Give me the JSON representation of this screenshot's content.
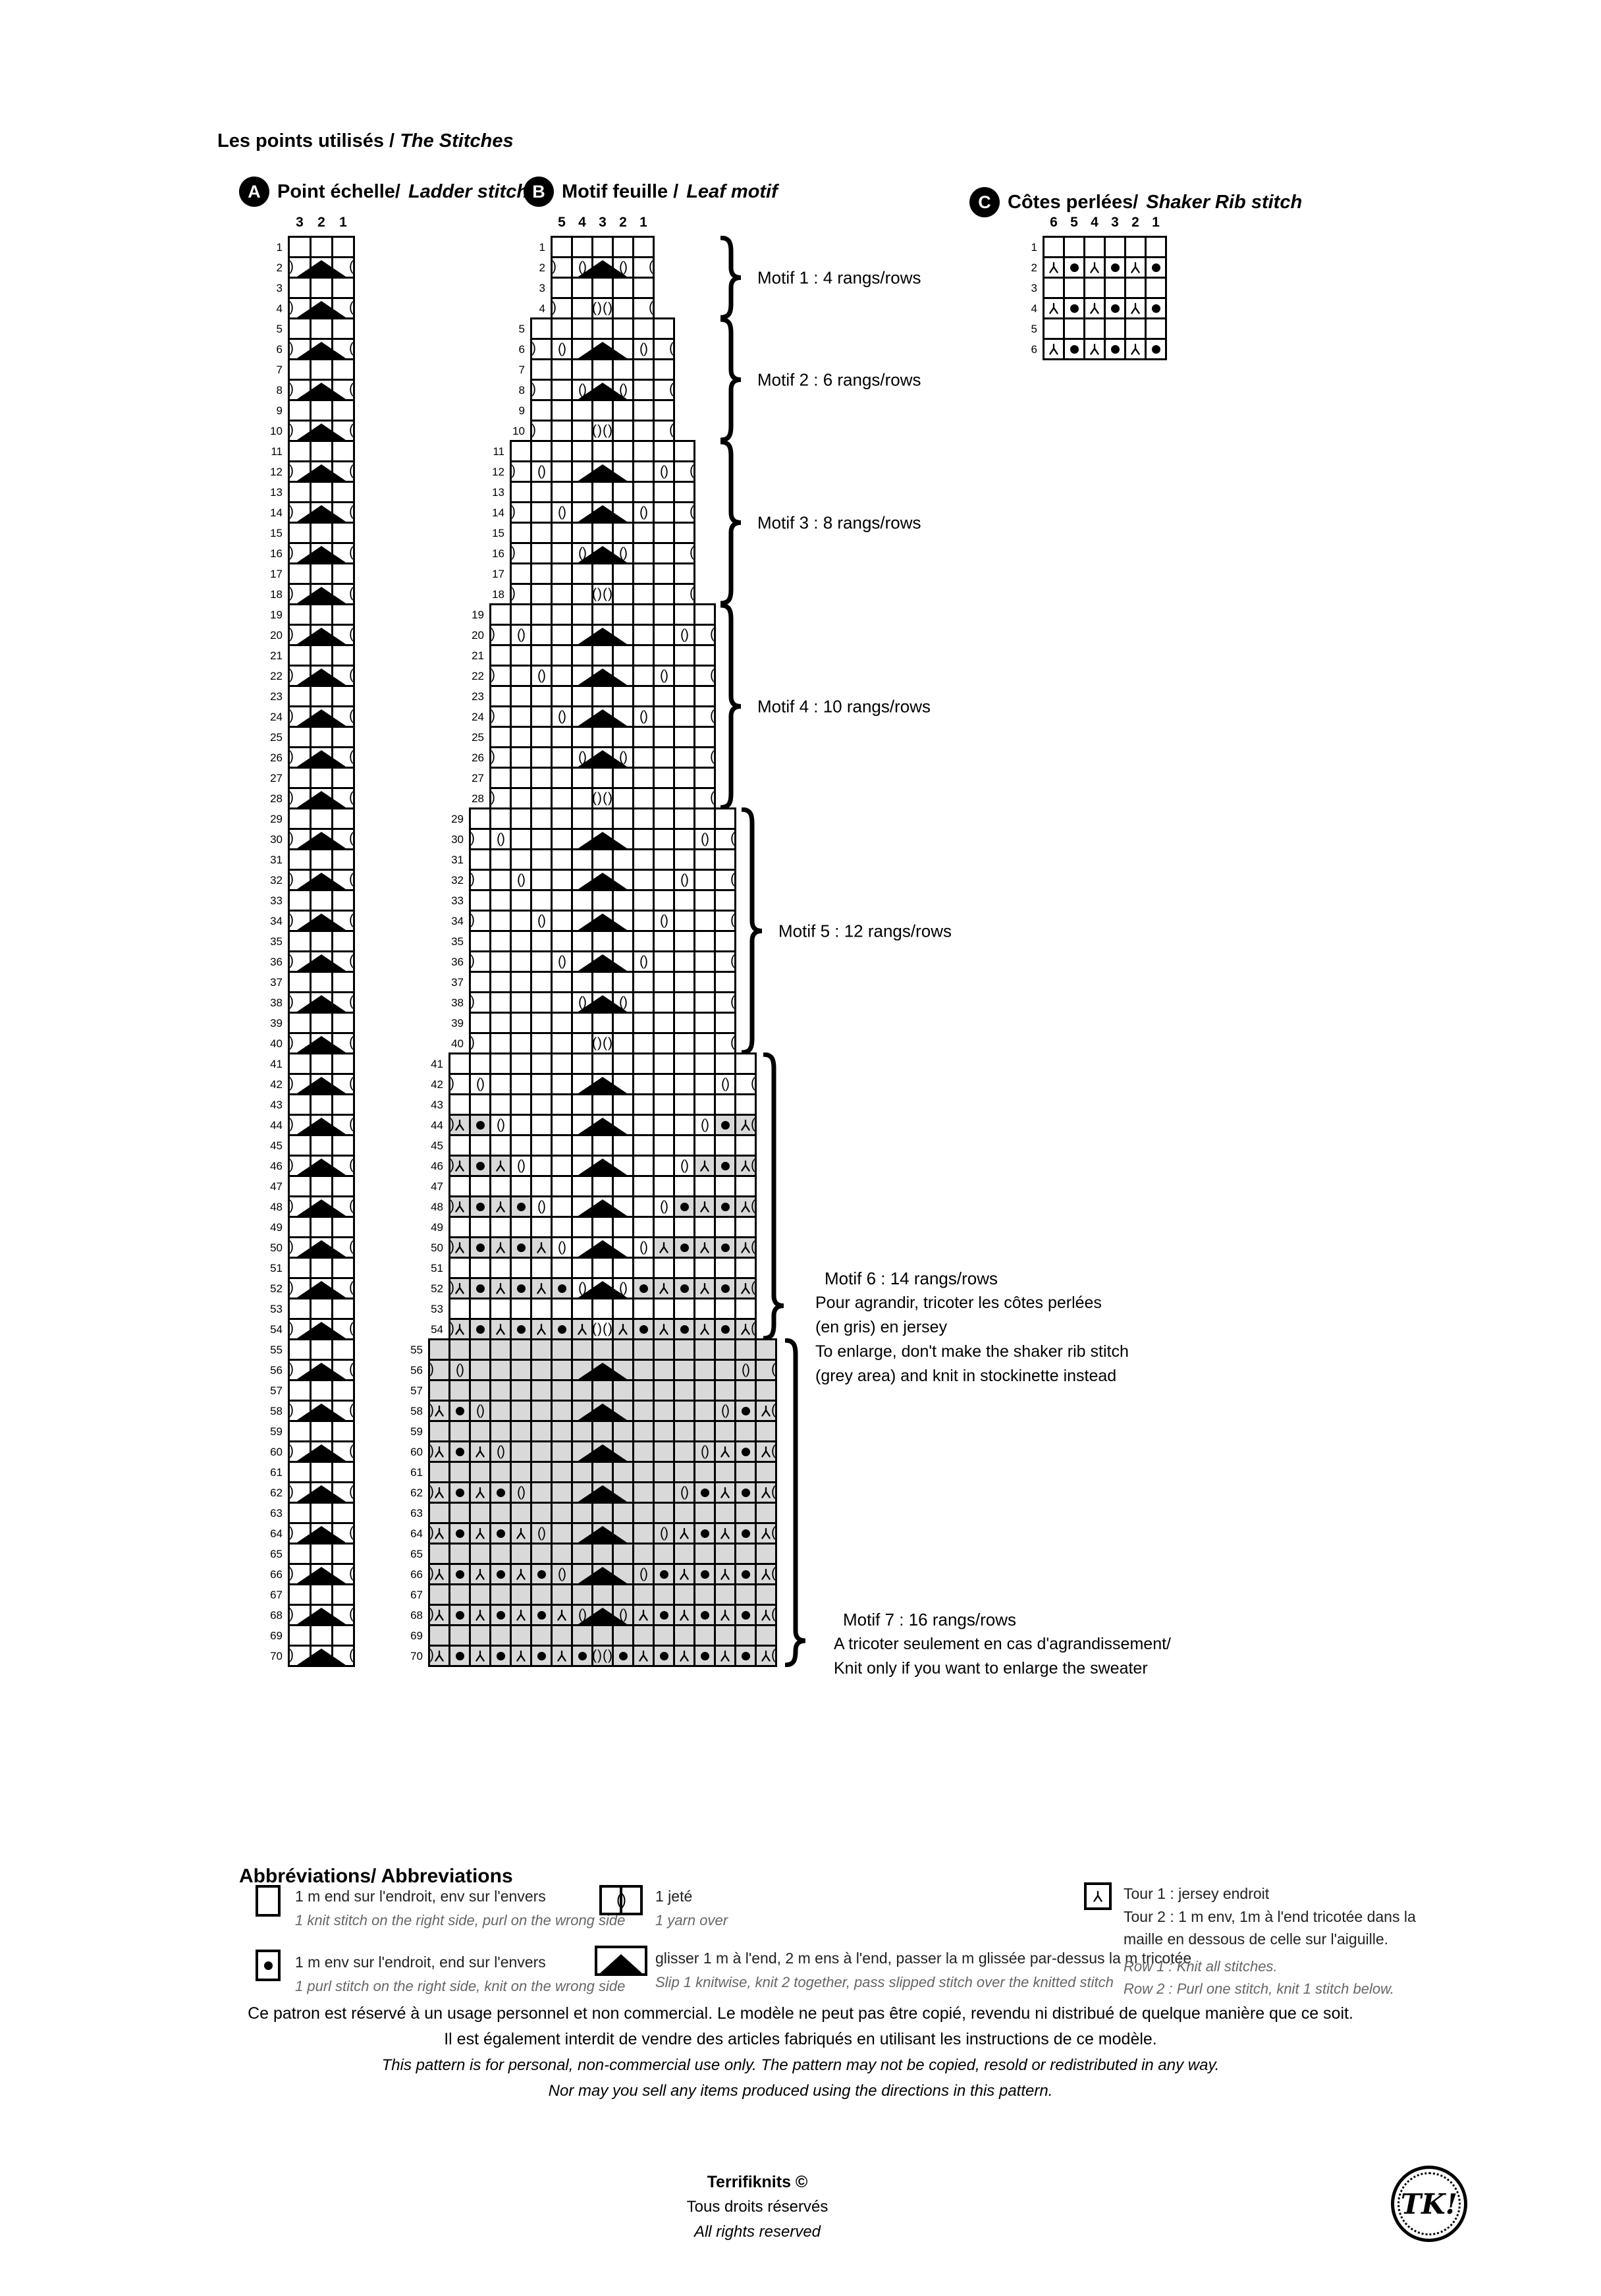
{
  "title": {
    "fr": "Les points utilisés /",
    "en": "The Stitches"
  },
  "colors": {
    "grey_cell": "#d9d9d9",
    "ink": "#000000"
  },
  "charts": {
    "A": {
      "badge": "A",
      "title_fr": "Point échelle/",
      "title_en": "Ladder stitch",
      "col_labels": [
        "3",
        "2",
        "1"
      ],
      "row_count": 70,
      "odd_row": "...",
      "even_row": ".A.",
      "edge_on_even": true
    },
    "B": {
      "badge": "B",
      "title_fr": "Motif feuille /",
      "title_en": "Leaf motif",
      "col_labels": [
        "5",
        "4",
        "3",
        "2",
        "1"
      ],
      "rows": [
        {
          "c": "....."
        },
        {
          "c": ".oAo.",
          "e": 1
        },
        {
          "c": "....."
        },
        {
          "c": "..O..",
          "e": 1
        },
        {
          "c": "......."
        },
        {
          "c": ".o.A.o.",
          "e": 1
        },
        {
          "c": "......."
        },
        {
          "c": "..oAo..",
          "e": 1
        },
        {
          "c": "......."
        },
        {
          "c": "...O...",
          "e": 1
        },
        {
          "c": "........."
        },
        {
          "c": ".o..A..o.",
          "e": 1
        },
        {
          "c": "........."
        },
        {
          "c": "..o.A.o..",
          "e": 1
        },
        {
          "c": "........."
        },
        {
          "c": "...oAo...",
          "e": 1
        },
        {
          "c": "........."
        },
        {
          "c": "....O....",
          "e": 1
        },
        {
          "c": "..........."
        },
        {
          "c": ".o...A...o.",
          "e": 1
        },
        {
          "c": "..........."
        },
        {
          "c": "..o..A..o..",
          "e": 1
        },
        {
          "c": "..........."
        },
        {
          "c": "...o.A.o...",
          "e": 1
        },
        {
          "c": "..........."
        },
        {
          "c": "....oAo....",
          "e": 1
        },
        {
          "c": "..........."
        },
        {
          "c": ".....O.....",
          "e": 1
        },
        {
          "c": "............."
        },
        {
          "c": ".o....A....o.",
          "e": 1
        },
        {
          "c": "............."
        },
        {
          "c": "..o...A...o..",
          "e": 1
        },
        {
          "c": "............."
        },
        {
          "c": "...o..A..o...",
          "e": 1
        },
        {
          "c": "............."
        },
        {
          "c": "....o.A.o....",
          "e": 1
        },
        {
          "c": "............."
        },
        {
          "c": ".....oAo.....",
          "e": 1
        },
        {
          "c": "............."
        },
        {
          "c": "......O......",
          "e": 1
        },
        {
          "c": "...............",
          "g": "rib"
        },
        {
          "c": ".o.....A.....o.",
          "e": 1,
          "g": "rib"
        },
        {
          "c": "...............",
          "g": "rib"
        },
        {
          "c": "kpo....A....opk",
          "e": 1,
          "g": "rib"
        },
        {
          "c": "...............",
          "g": "rib"
        },
        {
          "c": "kpko...A...okpk",
          "e": 1,
          "g": "rib"
        },
        {
          "c": "...............",
          "g": "rib"
        },
        {
          "c": "kpkpo..A..opkpk",
          "e": 1,
          "g": "rib"
        },
        {
          "c": "...............",
          "g": "rib"
        },
        {
          "c": "kpkpko.A.okpkpk",
          "e": 1,
          "g": "rib"
        },
        {
          "c": "...............",
          "g": "rib"
        },
        {
          "c": "kpkpkpoAopkpkpk",
          "e": 1,
          "g": "rib"
        },
        {
          "c": "...............",
          "g": "rib"
        },
        {
          "c": "kpkpkpkOkpkpkpk",
          "e": 1,
          "g": "rib"
        },
        {
          "c": ".................",
          "g": "all"
        },
        {
          "c": ".o......A......o.",
          "e": 1,
          "g": "all"
        },
        {
          "c": ".................",
          "g": "all"
        },
        {
          "c": "kpo.....A.....opk",
          "e": 1,
          "g": "all"
        },
        {
          "c": ".................",
          "g": "all"
        },
        {
          "c": "kpko....A....okpk",
          "e": 1,
          "g": "all"
        },
        {
          "c": ".................",
          "g": "all"
        },
        {
          "c": "kpkpo...A...opkpk",
          "e": 1,
          "g": "all"
        },
        {
          "c": ".................",
          "g": "all"
        },
        {
          "c": "kpkpko..A..okpkpk",
          "e": 1,
          "g": "all"
        },
        {
          "c": ".................",
          "g": "all"
        },
        {
          "c": "kpkpkpo.A.opkpkpk",
          "e": 1,
          "g": "all"
        },
        {
          "c": ".................",
          "g": "all"
        },
        {
          "c": "kpkpkpkoAokpkpkpk",
          "e": 1,
          "g": "all"
        },
        {
          "c": ".................",
          "g": "all"
        },
        {
          "c": "kpkpkpkpOpkpkpkpk",
          "e": 1,
          "g": "all"
        }
      ]
    },
    "C": {
      "badge": "C",
      "title_fr": "Côtes perlées/",
      "title_en": "Shaker Rib stitch",
      "col_labels": [
        "6",
        "5",
        "4",
        "3",
        "2",
        "1"
      ],
      "rows": [
        {
          "c": "......"
        },
        {
          "c": "kpkpkp"
        },
        {
          "c": "......"
        },
        {
          "c": "kpkpkp"
        },
        {
          "c": "......"
        },
        {
          "c": "kpkpkp"
        }
      ]
    }
  },
  "motifs": [
    {
      "label": "Motif 1 : 4 rangs/rows"
    },
    {
      "label": "Motif 2 : 6 rangs/rows"
    },
    {
      "label": "Motif 3 : 8 rangs/rows"
    },
    {
      "label": "Motif 4 : 10 rangs/rows"
    },
    {
      "label": "Motif 5 : 12 rangs/rows"
    },
    {
      "label": "Motif 6 : 14 rangs/rows",
      "notes": [
        "Pour agrandir, tricoter les côtes perlées",
        "(en gris) en jersey",
        "To enlarge, don't make the shaker rib stitch",
        "(grey area) and knit in stockinette instead"
      ]
    },
    {
      "label": "Motif 7 : 16 rangs/rows",
      "notes": [
        "A tricoter seulement en cas d'agrandissement/",
        "Knit only if you want to enlarge the sweater"
      ]
    }
  ],
  "abbreviations": {
    "title": "Abbréviations/ Abbreviations",
    "knit": {
      "fr": "1 m end sur l'endroit, env sur l'envers",
      "en": "1 knit stitch on the right side, purl on the wrong side"
    },
    "purl": {
      "fr": "1 m env sur l'endroit, end sur l'envers",
      "en": "1 purl stitch on the right side, knit on the wrong side"
    },
    "yarn_over": {
      "fr": "1 jeté",
      "en": "1 yarn over"
    },
    "decrease": {
      "fr": "glisser 1 m à l'end, 2 m ens à l'end, passer la m glissée par-dessus la m tricotée",
      "en": "Slip 1 knitwise, knit 2 together, pass slipped stitch over the knitted stitch"
    },
    "knit_below": {
      "fr1": "Tour 1 : jersey endroit",
      "fr2": "Tour 2 :  1 m env, 1m à l'end tricotée dans la",
      "fr3": "maille en dessous de celle sur l'aiguille.",
      "en1": "Row 1 : Knit all stitches.",
      "en2": "Row 2 : Purl one stitch, knit 1 stitch below."
    }
  },
  "copyright": [
    {
      "text": "Ce patron est réservé à un usage personnel et non commercial. Le modèle ne peut pas être copié, revendu ni distribué de quelque manière que ce soit.",
      "italic": false
    },
    {
      "text": "Il est également interdit de vendre des articles fabriqués en utilisant les instructions de ce modèle.",
      "italic": false
    },
    {
      "text": "This pattern is for personal, non-commercial use only. The pattern may not be copied, resold or redistributed in any way.",
      "italic": true
    },
    {
      "text": "Nor may you sell any items produced using the directions in this pattern.",
      "italic": true
    }
  ],
  "footer": {
    "brand": "Terrifiknits ©",
    "fr": "Tous droits réservés",
    "en": "All rights reserved",
    "logo": "TK!"
  }
}
